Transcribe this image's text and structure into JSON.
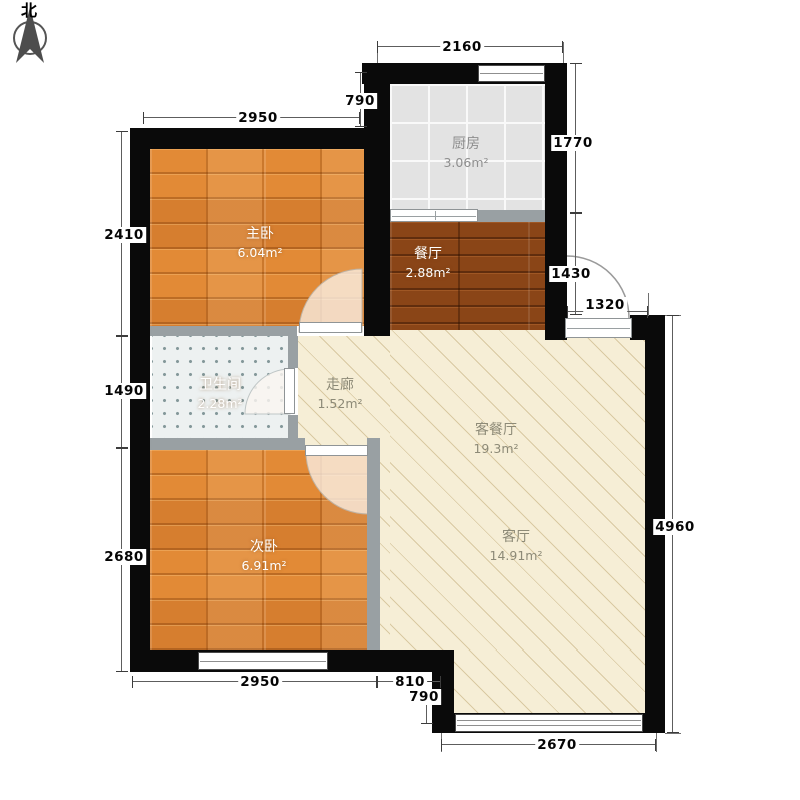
{
  "compass": {
    "label": "北"
  },
  "rooms": [
    {
      "id": "kitchen",
      "name": "厨房",
      "area": "3.06m²"
    },
    {
      "id": "master-bedroom",
      "name": "主卧",
      "area": "6.04m²"
    },
    {
      "id": "dining-room",
      "name": "餐厅",
      "area": "2.88m²"
    },
    {
      "id": "bathroom",
      "name": "卫生间",
      "area": "2.28m²"
    },
    {
      "id": "corridor",
      "name": "走廊",
      "area": "1.52m²"
    },
    {
      "id": "second-bedroom",
      "name": "次卧",
      "area": "6.91m²"
    },
    {
      "id": "living-dining",
      "name": "客餐厅",
      "area": "19.3m²"
    },
    {
      "id": "living-room",
      "name": "客厅",
      "area": "14.91m²"
    }
  ],
  "dims": {
    "top_2160": "2160",
    "top_790": "790",
    "top_2950": "2950",
    "left_2410": "2410",
    "left_1490": "1490",
    "left_2680": "2680",
    "right_1770": "1770",
    "right_1430": "1430",
    "right_1320": "1320",
    "right_4960": "4960",
    "bottom_2950": "2950",
    "bottom_810": "810",
    "bottom_790": "790",
    "bottom_2670": "2670"
  },
  "colors": {
    "wall": "#0a0a0a",
    "partition": "#99a0a3",
    "wood_floor": "#dd8433",
    "dark_wood_floor": "#8a4517",
    "kitchen_tile": "#e3e3e3",
    "bath_tile": "#edf1f1",
    "living_floor": "#f6eed6",
    "hatch_line": "#d9c9a2"
  }
}
